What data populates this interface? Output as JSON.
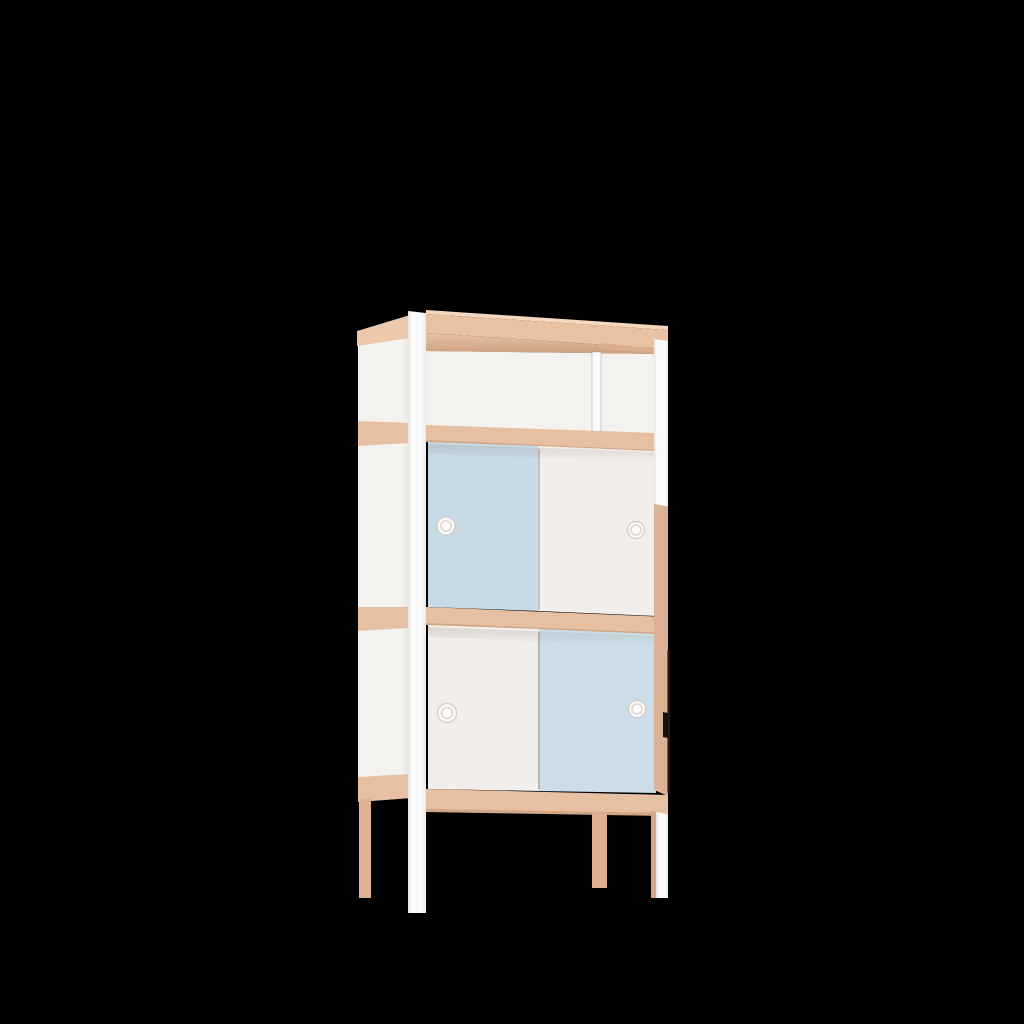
{
  "scene": {
    "type": "3d-product-render",
    "object": "storage cabinet with open top shelf and two sliding-door compartments",
    "view": "three-quarter front-left elevation",
    "background_color": "#000000"
  },
  "colors": {
    "background": "#000000",
    "wood": "#e7c0a3",
    "wood_top": "#e9c2a4",
    "wood_light": "#f4d8bf",
    "wood_light2": "#ecc8ac",
    "wood_mid": "#e2b494",
    "wood_dark": "#dcae8e",
    "wood_edge": "rgba(160,105,65,0.30)",
    "strip_wood": "#dcb295",
    "panel_white": "#f4f2ef",
    "door_white": "#f1eeeb",
    "blue_upper": "#c8dae5",
    "blue_lower": "#ccdde8",
    "post_white": "#fbfafa",
    "leg_wood": "#dfb092",
    "leg_wood_dark": "#d8a686",
    "knob_white": "#fcfbfa",
    "knob_rim": "#d2ccc7",
    "gap_dark": "#141008"
  },
  "cabinet": {
    "sections": [
      {
        "name": "open-top-shelf",
        "doors": 0,
        "has_divider": true
      },
      {
        "name": "upper-compartment",
        "doors": 2,
        "left_door": "blue",
        "right_door": "white"
      },
      {
        "name": "lower-compartment",
        "doors": 2,
        "left_door": "white",
        "right_door": "blue"
      }
    ],
    "knob_count": 4,
    "leg_count": 4,
    "frame_material": "light wood",
    "post_material": "white lacquer"
  }
}
